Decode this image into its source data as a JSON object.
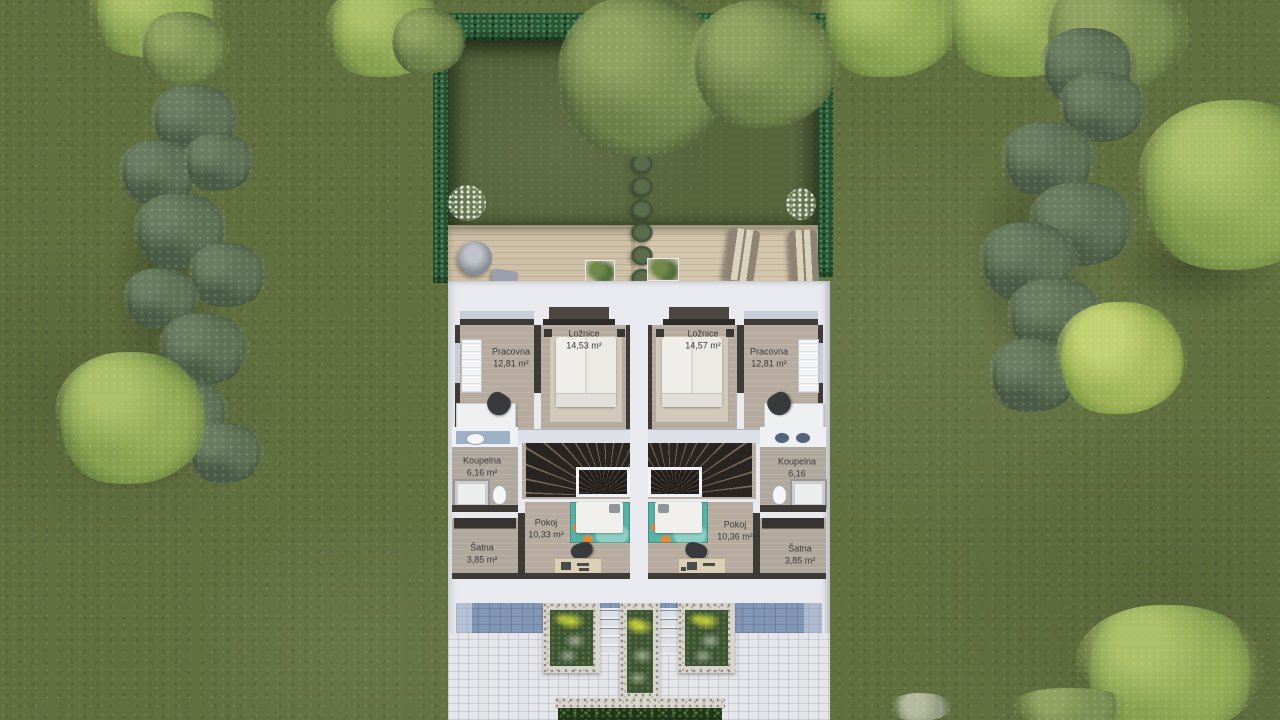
{
  "scene": {
    "description": "Top-down architectural rendering of a semi-detached duplex upper-floor plan with back garden, wooden terrace and front paving",
    "floor": "upper floor"
  },
  "rooms": {
    "left": {
      "pracovna": {
        "name": "Pracovna",
        "area": "12,81 m²"
      },
      "loznice": {
        "name": "Ložnice",
        "area": "14,53 m²"
      },
      "koupelna": {
        "name": "Koupelna",
        "area": "6,16 m²"
      },
      "satna": {
        "name": "Šatna",
        "area": "3,85 m²"
      },
      "pokoj": {
        "name": "Pokoj",
        "area": "10,33 m²"
      }
    },
    "right": {
      "loznice": {
        "name": "Ložnice",
        "area": "14,57 m²"
      },
      "pracovna": {
        "name": "Pracovna",
        "area": "12,81 m²"
      },
      "koupelna": {
        "name": "Koupelna",
        "area": "6,16"
      },
      "pokoj": {
        "name": "Pokoj",
        "area": "10,36 m²"
      },
      "satna": {
        "name": "Šatna",
        "area": "3,85 m²"
      }
    }
  },
  "palette": {
    "grass": "#61703f",
    "hedge": "#2b5737",
    "deck_wood": "#cfc1a8",
    "slab": "#e9eaef",
    "room_floor": "#b6ab9e",
    "wall": "#3e3a36",
    "teal_rug": "#58b1a6",
    "shadow_band": "#8296b6",
    "planter_green": "#3c5430"
  }
}
